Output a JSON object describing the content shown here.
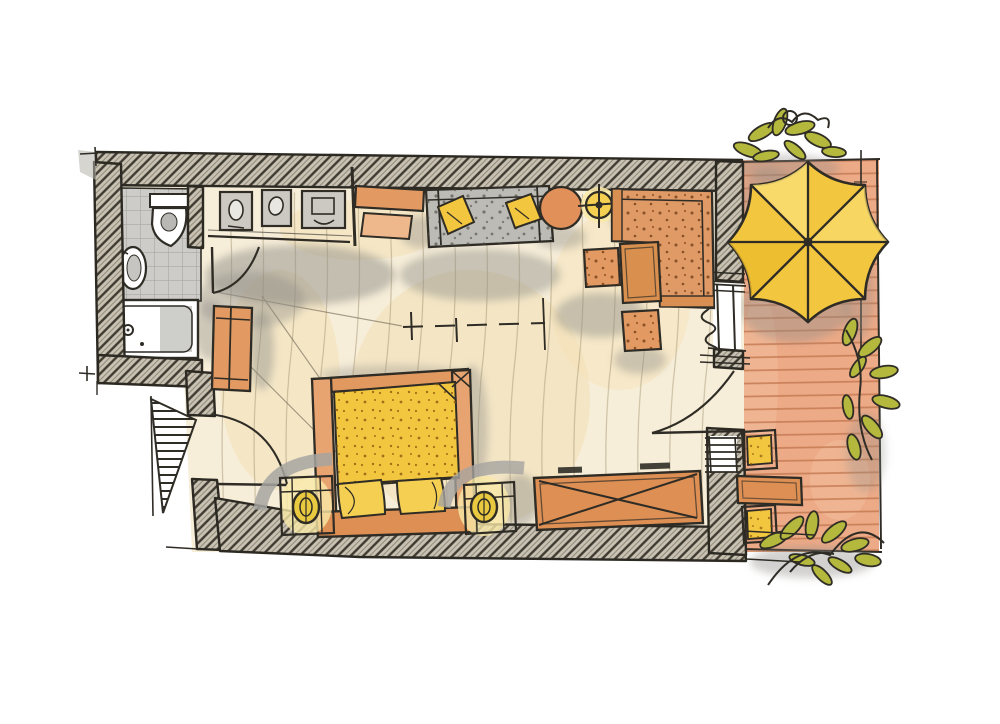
{
  "document": {
    "type": "hand-drawn floor plan sketch",
    "subject": "hotel guest room with bathroom, entry hall, bed/living area and terrace",
    "visible_text": [],
    "areas": [
      {
        "name": "bathroom",
        "items": [
          "toilet",
          "washbasin",
          "bathtub",
          "tiled-floor"
        ]
      },
      {
        "name": "entry-hall",
        "items": [
          "entry-door",
          "built-in-cabinet-1",
          "built-in-cabinet-2",
          "built-in-cabinet-3",
          "wardrobe",
          "bathroom-door",
          "entrance-marker-triangle"
        ]
      },
      {
        "name": "bed-living-room",
        "items": [
          "console-desk",
          "desk-bench",
          "sofa-with-two-pillows",
          "round-side-table",
          "floor-lamp",
          "corner-lounge-sofa",
          "coffee-table",
          "stool-1",
          "stool-2",
          "double-bed",
          "yellow-duvet",
          "two-pillows",
          "nightstand-left",
          "nightstand-right",
          "bedside-lamp-left",
          "bedside-lamp-right",
          "luggage-bench",
          "terrace-door",
          "window-upper",
          "window-lower",
          "curtain-coil",
          "dashed-section-line"
        ]
      },
      {
        "name": "terrace",
        "items": [
          "parasol",
          "outdoor-chair-1",
          "outdoor-chair-2",
          "outdoor-table",
          "plant-top",
          "plant-right",
          "plant-bottom",
          "wood-decking",
          "railing"
        ]
      }
    ]
  },
  "colors": {
    "ink": "#2f2c26",
    "wall": "#c9c2b3",
    "wallLine": "#3e3a30",
    "floor": "#f7eed9",
    "floorWash": "#f3e0b4",
    "tile": "#cdccc8",
    "orange": "#e29a62",
    "orangeDeep": "#dd8f54",
    "orangeLight": "#eeb88c",
    "orangeSofa": "#e09a66",
    "wood": "#d9904e",
    "terracotta": "#edaa87",
    "terracottaLine": "#c57a52",
    "yellow": "#f2c63e",
    "yellowPillow": "#f4cf52",
    "yellowSoft": "#f8e087",
    "glow": "#f9e9a8",
    "olive": "#b4b83c",
    "graySofa": "#bdbbb5",
    "grayFixture": "#c6c5c1",
    "shadow": "#8f8d88",
    "white": "#ffffff"
  }
}
